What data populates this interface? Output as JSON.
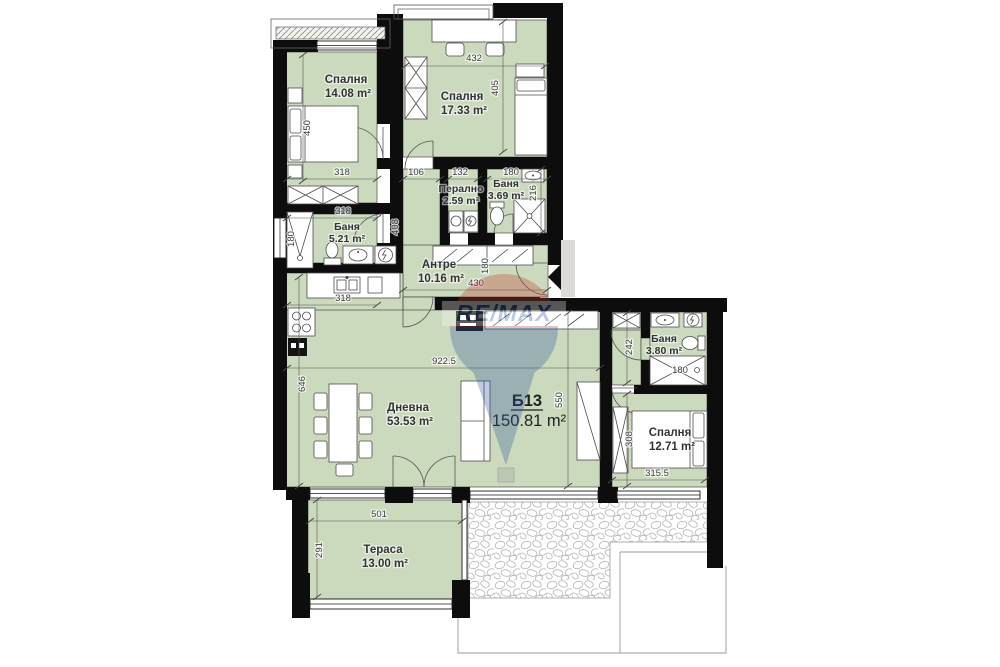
{
  "plan": {
    "unit": {
      "id": "Б13",
      "total_area": "150.81 m²"
    },
    "rooms": {
      "bedroom1": {
        "name": "Спалня",
        "area": "14.08 m²"
      },
      "bedroom2": {
        "name": "Спалня",
        "area": "17.33 m²"
      },
      "laundry": {
        "name": "Перално",
        "area": "2.59 m²"
      },
      "bathroom2": {
        "name": "Баня",
        "area": "3.69 m²"
      },
      "bathroom1": {
        "name": "Баня",
        "area": "5.21 m²"
      },
      "hall": {
        "name": "Антре",
        "area": "10.16 m²"
      },
      "living": {
        "name": "Дневна",
        "area": "53.53 m²"
      },
      "bathroom3": {
        "name": "Баня",
        "area": "3.80 m²"
      },
      "bedroom3": {
        "name": "Спалня",
        "area": "12.71 m²"
      },
      "terrace": {
        "name": "Тераса",
        "area": "13.00 m²"
      }
    },
    "dims": {
      "d432": "432",
      "d405": "405",
      "d450": "450",
      "d318_bed1": "318",
      "d106": "106",
      "d132": "132",
      "d180_bath2": "180",
      "d216": "216",
      "d318_ward": "318",
      "d180_tub": "180",
      "d408": "408",
      "d430": "430",
      "d180_antre": "180",
      "d318_kitchen": "318",
      "d922": "922.5",
      "d646": "646",
      "d550": "550",
      "d242": "242",
      "d180_shower": "180",
      "d308": "308",
      "d315": "315.5",
      "d501": "501",
      "d291": "291"
    },
    "watermark": {
      "brand": "RE/MAX"
    }
  },
  "colors": {
    "room_fill": "#cbd9bc",
    "wall": "#0d0d0d",
    "watermark_red": "#c0392b",
    "watermark_blue": "#2b559f"
  }
}
